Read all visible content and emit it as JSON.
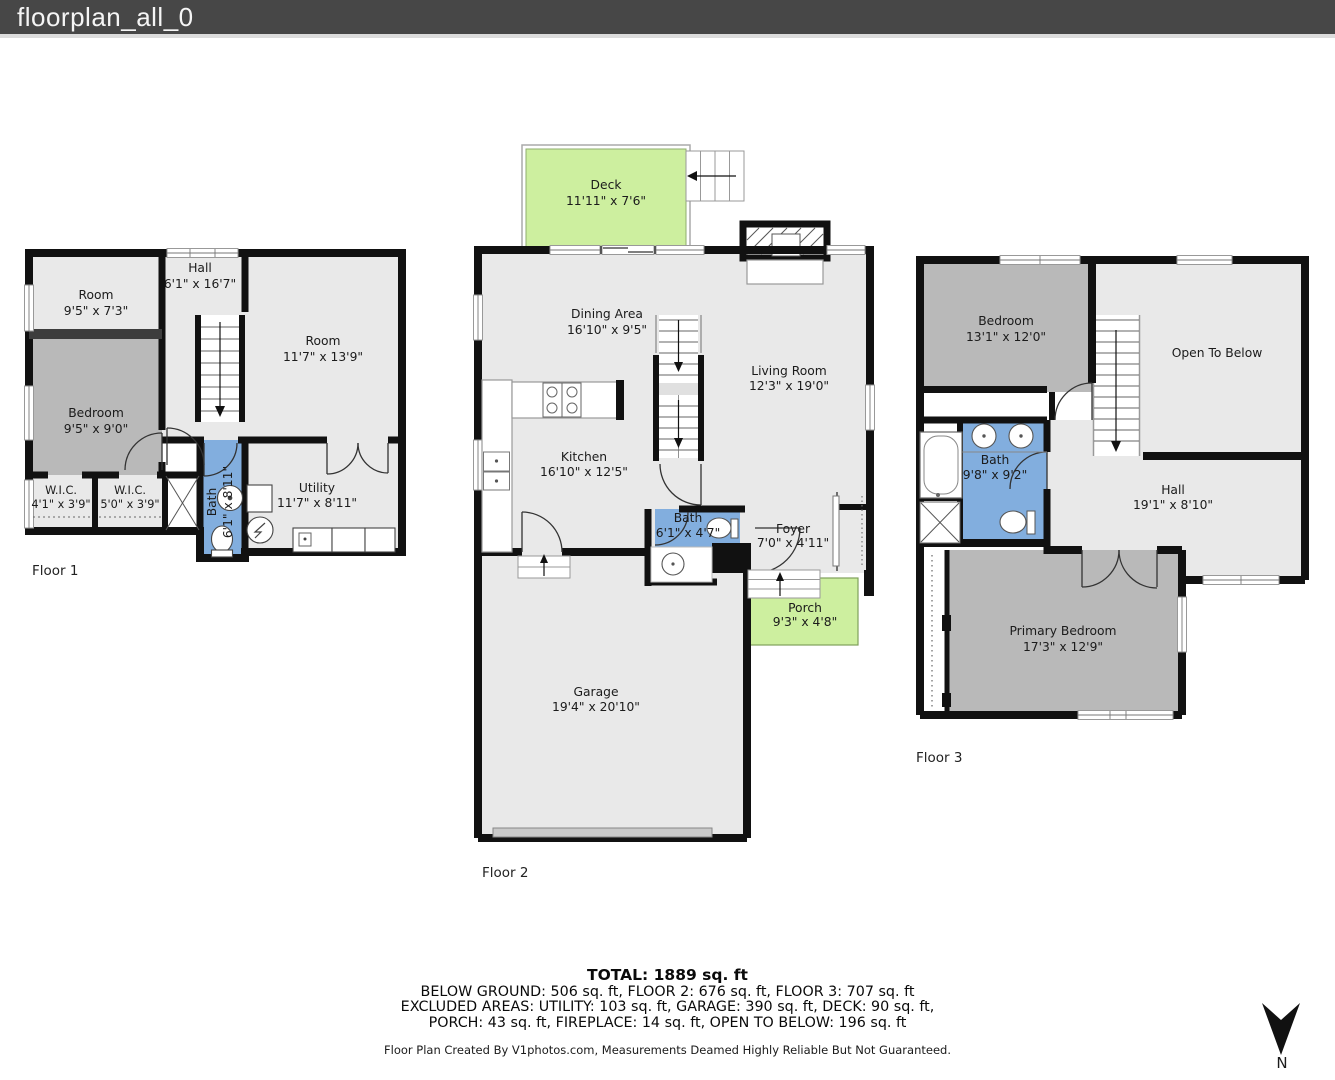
{
  "window": {
    "title": "floorplan_all_0"
  },
  "colors": {
    "titlebar_bg": "#474747",
    "wall": "#111111",
    "room_light": "#e9e9e9",
    "room_dark": "#b9b9b9",
    "bath_blue": "#82aede",
    "outdoor_green": "#cdef9f"
  },
  "floor1": {
    "label": "Floor 1",
    "rooms": {
      "room_a": {
        "name": "Room",
        "dims": "9'5\" x 7'3\""
      },
      "hall": {
        "name": "Hall",
        "dims": "6'1\" x 16'7\""
      },
      "room_b": {
        "name": "Room",
        "dims": "11'7\" x 13'9\""
      },
      "bedroom": {
        "name": "Bedroom",
        "dims": "9'5\" x 9'0\""
      },
      "wic_1": {
        "name": "W.I.C.",
        "dims": "4'1\" x 3'9\""
      },
      "wic_2": {
        "name": "W.I.C.",
        "dims": "5'0\" x 3'9\""
      },
      "bath": {
        "name": "Bath",
        "dims": "6'1\" x 8'11\""
      },
      "utility": {
        "name": "Utility",
        "dims": "11'7\" x 8'11\""
      }
    }
  },
  "floor2": {
    "label": "Floor 2",
    "rooms": {
      "deck": {
        "name": "Deck",
        "dims": "11'11\" x 7'6\""
      },
      "dining": {
        "name": "Dining Area",
        "dims": "16'10\" x 9'5\""
      },
      "living": {
        "name": "Living Room",
        "dims": "12'3\" x 19'0\""
      },
      "kitchen": {
        "name": "Kitchen",
        "dims": "16'10\" x 12'5\""
      },
      "bath": {
        "name": "Bath",
        "dims": "6'1\" x 4'7\""
      },
      "foyer": {
        "name": "Foyer",
        "dims": "7'0\" x 4'11\""
      },
      "porch": {
        "name": "Porch",
        "dims": "9'3\" x 4'8\""
      },
      "garage": {
        "name": "Garage",
        "dims": "19'4\" x 20'10\""
      }
    }
  },
  "floor3": {
    "label": "Floor 3",
    "rooms": {
      "bedroom": {
        "name": "Bedroom",
        "dims": "13'1\" x 12'0\""
      },
      "open_below": {
        "name": "Open To Below",
        "dims": ""
      },
      "bath": {
        "name": "Bath",
        "dims": "9'8\" x 9'2\""
      },
      "hall": {
        "name": "Hall",
        "dims": "19'1\" x 8'10\""
      },
      "primary": {
        "name": "Primary Bedroom",
        "dims": "17'3\" x 12'9\""
      }
    }
  },
  "summary": {
    "total": "TOTAL: 1889 sq. ft",
    "line1": "BELOW GROUND: 506 sq. ft, FLOOR 2: 676 sq. ft, FLOOR 3: 707 sq. ft",
    "line2": "EXCLUDED AREAS: UTILITY: 103 sq. ft, GARAGE: 390 sq. ft, DECK: 90 sq. ft,",
    "line3": "PORCH: 43 sq. ft, FIREPLACE: 14 sq. ft, OPEN TO BELOW: 196 sq. ft",
    "disclaimer": "Floor Plan Created By V1photos.com, Measurements Deamed Highly Reliable But Not Guaranteed."
  },
  "compass": {
    "label": "N"
  }
}
